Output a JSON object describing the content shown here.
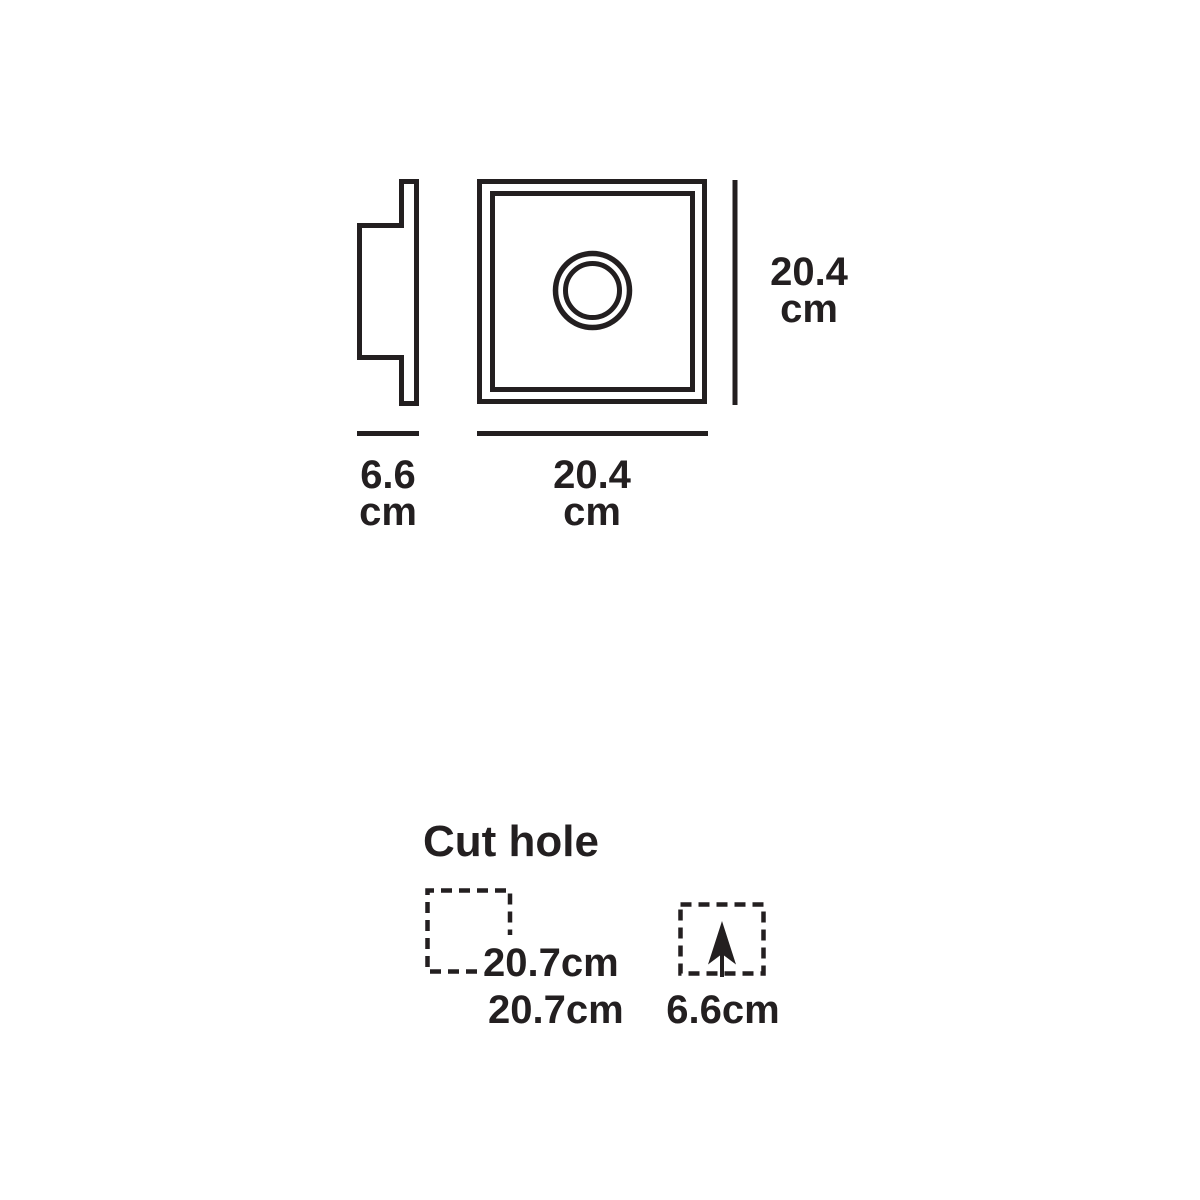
{
  "page": {
    "background_color": "#ffffff",
    "ink_color": "#231f20"
  },
  "views": {
    "side_view": {
      "width_value": "6.6\ncm"
    },
    "front_view": {
      "width_value": "20.4\ncm",
      "height_value": "20.4\ncm"
    }
  },
  "cut_hole": {
    "title": "Cut hole",
    "hole_width": "20.7cm",
    "hole_height": "20.7cm",
    "hole_depth": "6.6cm"
  }
}
